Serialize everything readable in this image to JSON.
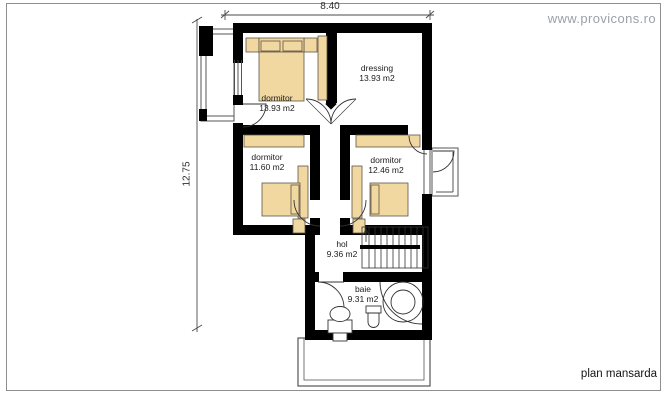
{
  "watermark": "www.provicons.ro",
  "plan_title": "plan mansarda",
  "dimensions": {
    "width_label": "8.40",
    "height_label": "12.75"
  },
  "rooms": [
    {
      "name": "dormitor",
      "area": "13.93 m2"
    },
    {
      "name": "dressing",
      "area": "13.93 m2"
    },
    {
      "name": "dormitor",
      "area": "11.60 m2"
    },
    {
      "name": "dormitor",
      "area": "12.46 m2"
    },
    {
      "name": "hol",
      "area": "9.36 m2"
    },
    {
      "name": "baie",
      "area": "9.31 m2"
    }
  ],
  "colors": {
    "wall": "#000000",
    "furniture": "#f1d7a0",
    "outline": "#4a4a4a",
    "watermark": "#9aa1a8"
  }
}
